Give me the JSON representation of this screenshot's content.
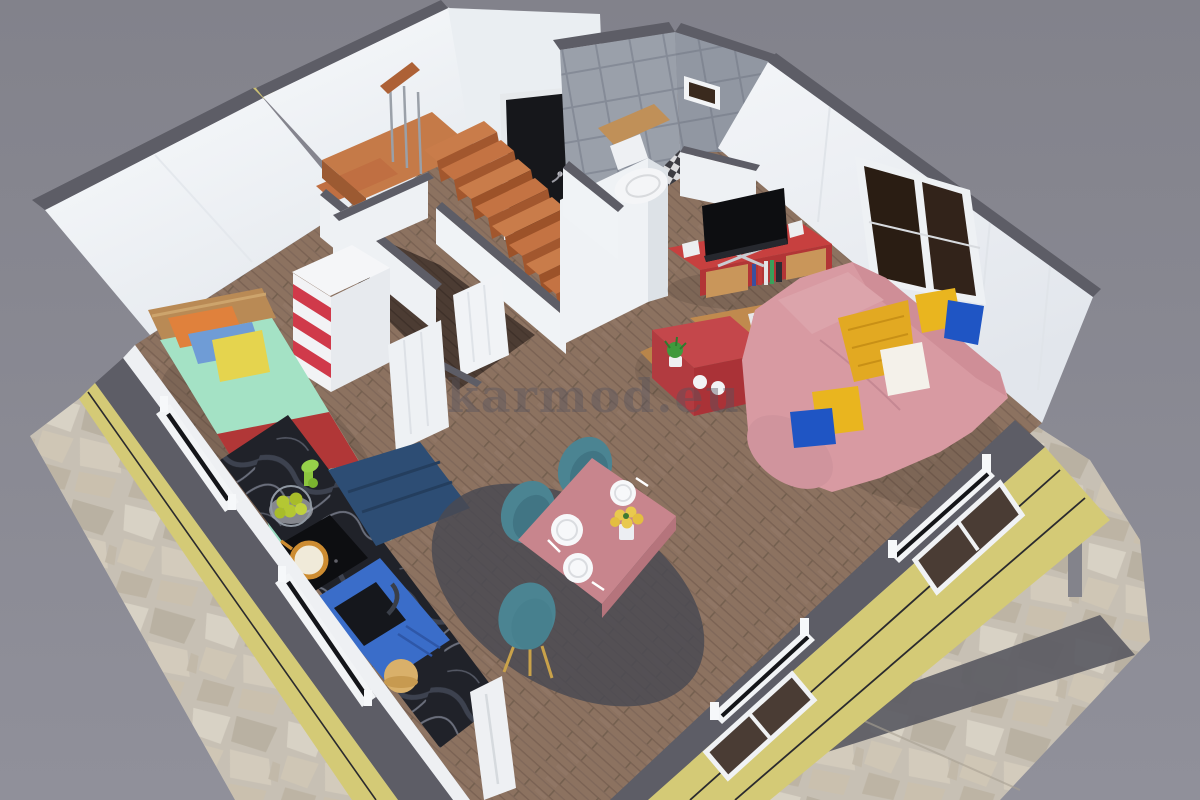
{
  "watermark": {
    "text": "karmod.eu"
  },
  "scene": {
    "background_top": "#83838c",
    "background_bottom": "#90909a",
    "colors": {
      "wall_white": "#f2f4f7",
      "wall_shade": "#e7ebef",
      "wall_top_gray": "#5d5d66",
      "siding_yellow": "#d4ca76",
      "stone_base": "#c7c0b4",
      "path_dark": "#5b5b63",
      "wood_floor": "#8c7260",
      "wood_floor_dark": "#4c3c33",
      "stair_tread": "#c97c4a",
      "stair_riser": "#a2572e",
      "tile_gray": "#9aa0aa",
      "door_black": "#16171b",
      "headboard_wood": "#b98a55",
      "bed_mint": "#a4e2c5",
      "bed_mint_dark": "#8fd4b4",
      "bed_red": "#b13737",
      "pillow_orange": "#e0813c",
      "pillow_skyblue": "#6f9cd6",
      "cushion_yellow": "#e5d44e",
      "dresser_stripe_red": "#d03a4a",
      "sofa_pink": "#d89aa2",
      "sofa_pink_dark": "#cf8e97",
      "pillow_yellow": "#e9b51f",
      "pillow_blue": "#1f55c4",
      "pillow_white": "#f4f1ea",
      "throw_yellow": "#e2a922",
      "tv_black": "#0d0e11",
      "tv_stand_red": "#c7403f",
      "cabinet_door_wood": "#c9965a",
      "coffee_table_wood": "#c08a4e",
      "coffee_table_red": "#c4474b",
      "plant_green": "#3f9a3d",
      "dining_table_pink": "#c8858d",
      "chair_teal": "#4b8492",
      "chair_leg_gold": "#c9a24a",
      "plate_white": "#f7f8fa",
      "flower_yellow": "#e9c94e",
      "counter_marble_black": "#202229",
      "kitchen_cabinet_blue": "#2d4d74",
      "sink_blue": "#3a6dc9",
      "pot_copper": "#cd8c31",
      "apple_green": "#b4c733",
      "mixer_green": "#8cc63f",
      "toilet_white": "#f4f5f7",
      "rug_gray": "#4a4a52",
      "watermark_gray": "#57545e"
    }
  }
}
